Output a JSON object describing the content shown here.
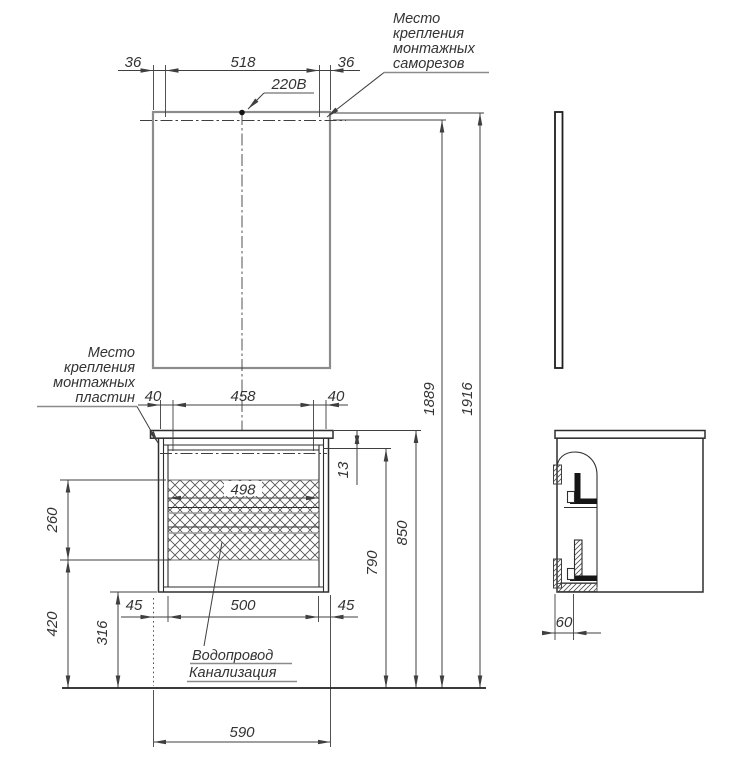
{
  "colors": {
    "line": "#2e2e2e",
    "dim": "#3f3f3f",
    "mirror": "#8c8c8c",
    "underline": "#8a8a8a",
    "text": "#333333",
    "background": "#ffffff"
  },
  "mirror_view": {
    "screw_offset_left": "36",
    "screw_spacing": "518",
    "screw_offset_right": "36",
    "power_label": "220В",
    "height_to_mount": "1889",
    "height_total": "1916",
    "screws_note": [
      "Место",
      "крепления",
      "монтажных",
      "саморезов"
    ]
  },
  "cabinet_view": {
    "plates_note": [
      "Место",
      "крепления",
      "монтажных",
      "пластин"
    ],
    "plate_offset_left": "40",
    "plate_spacing": "458",
    "plate_offset_right": "40",
    "interior_width": "498",
    "top_rail_offset": "13",
    "height_countertop": "850",
    "height_rail": "790",
    "drawer_zone_height": "260",
    "clearance_height": "420",
    "bottom_height": "316",
    "utility_offset_left": "45",
    "utility_width": "500",
    "utility_offset_right": "45",
    "overall_width": "590",
    "utilities_note": [
      "Водопровод",
      "Канализация"
    ]
  },
  "side_view": {
    "wall_offset": "60"
  }
}
